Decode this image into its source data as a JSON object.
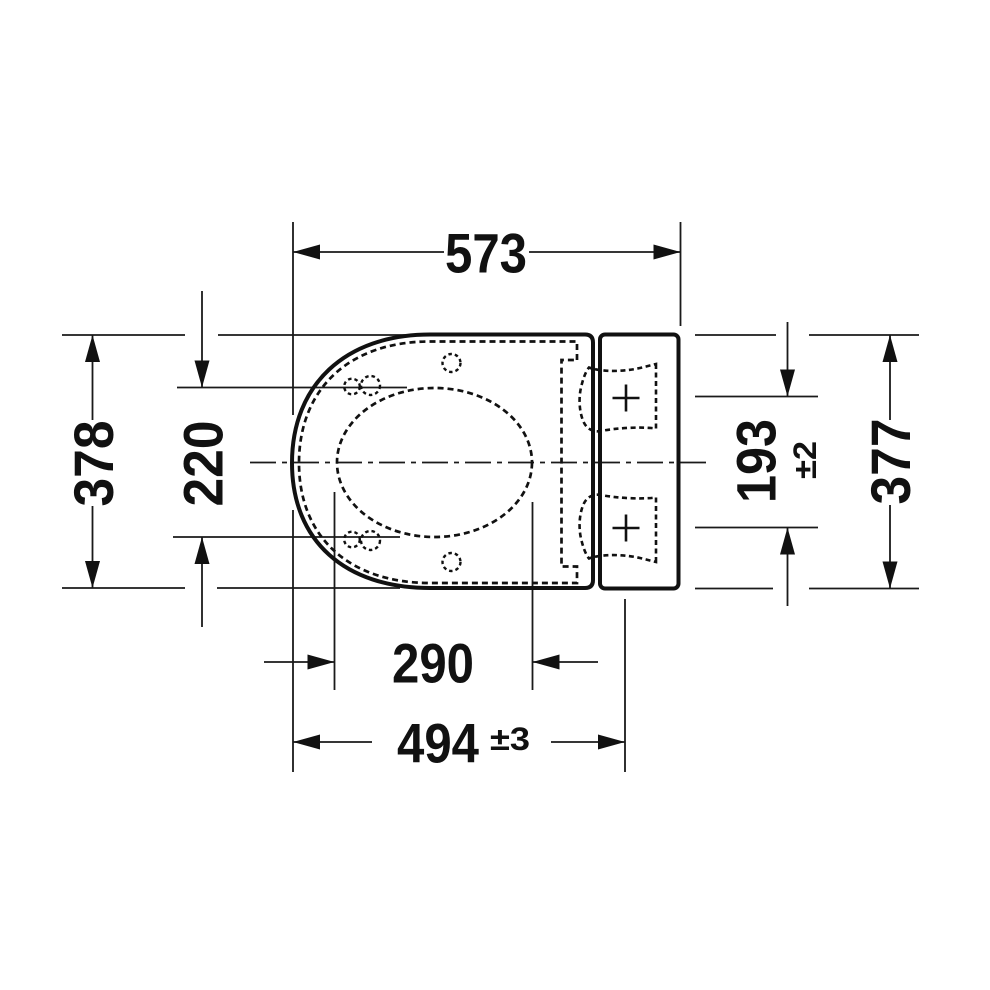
{
  "drawing": {
    "title": "toilet-seat-top-view-dimension-drawing",
    "units": "mm",
    "colors": {
      "line": "#111111",
      "background": "#ffffff"
    },
    "dims": {
      "top_width": "573",
      "seat_depth": "378",
      "opening_depth": "220",
      "mount_spacing": "193",
      "mount_spacing_tol": "±2",
      "plate_depth": "377",
      "opening_width": "290",
      "mount_distance": "494",
      "mount_distance_tol": "±3"
    }
  }
}
